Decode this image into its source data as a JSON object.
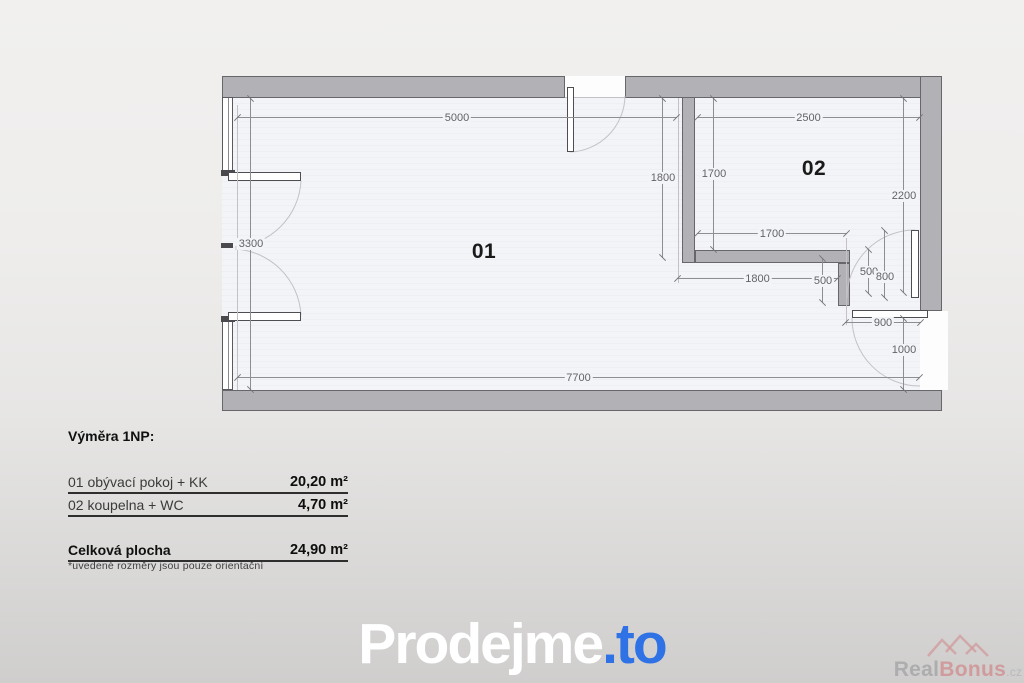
{
  "plan": {
    "rooms": [
      {
        "label": "01"
      },
      {
        "label": "02"
      }
    ],
    "dims": {
      "top_left_width": "5000",
      "bath_width": "2500",
      "partition_length": "1800",
      "bath_inner_height": "1700",
      "bath_right_height": "2200",
      "bath_inner_width": "1700",
      "nook_width": "1800",
      "stub_height": "500",
      "bath_door_clear": "500",
      "bath_door_width": "800",
      "entry_door_width": "900",
      "entry_clear": "1000",
      "left_height": "3300",
      "bottom_width": "7700"
    }
  },
  "legend": {
    "title": "Výměra 1NP:",
    "rows": [
      {
        "label": "01 obývací pokoj + KK",
        "value": "20,20 m²"
      },
      {
        "label": "02 koupelna + WC",
        "value": "4,70 m²"
      }
    ],
    "total": {
      "label": "Celková plocha",
      "value": "24,90 m²"
    },
    "note": "*uvedené rozměry jsou pouze orientační"
  },
  "branding": {
    "logo": {
      "primary": "Prodejme",
      "suffix": ".to",
      "accent_color": "#2e72e6"
    },
    "watermark": {
      "part1": "Real",
      "part2": "Bonus",
      "tld": ".cz"
    }
  },
  "colors": {
    "wall_fill": "#b2b2b6",
    "wall_border": "#67676b",
    "floor": "#f3f4f7",
    "dimension_text": "#636367",
    "logo_accent": "#2e72e6",
    "watermark_red": "#d09294"
  }
}
